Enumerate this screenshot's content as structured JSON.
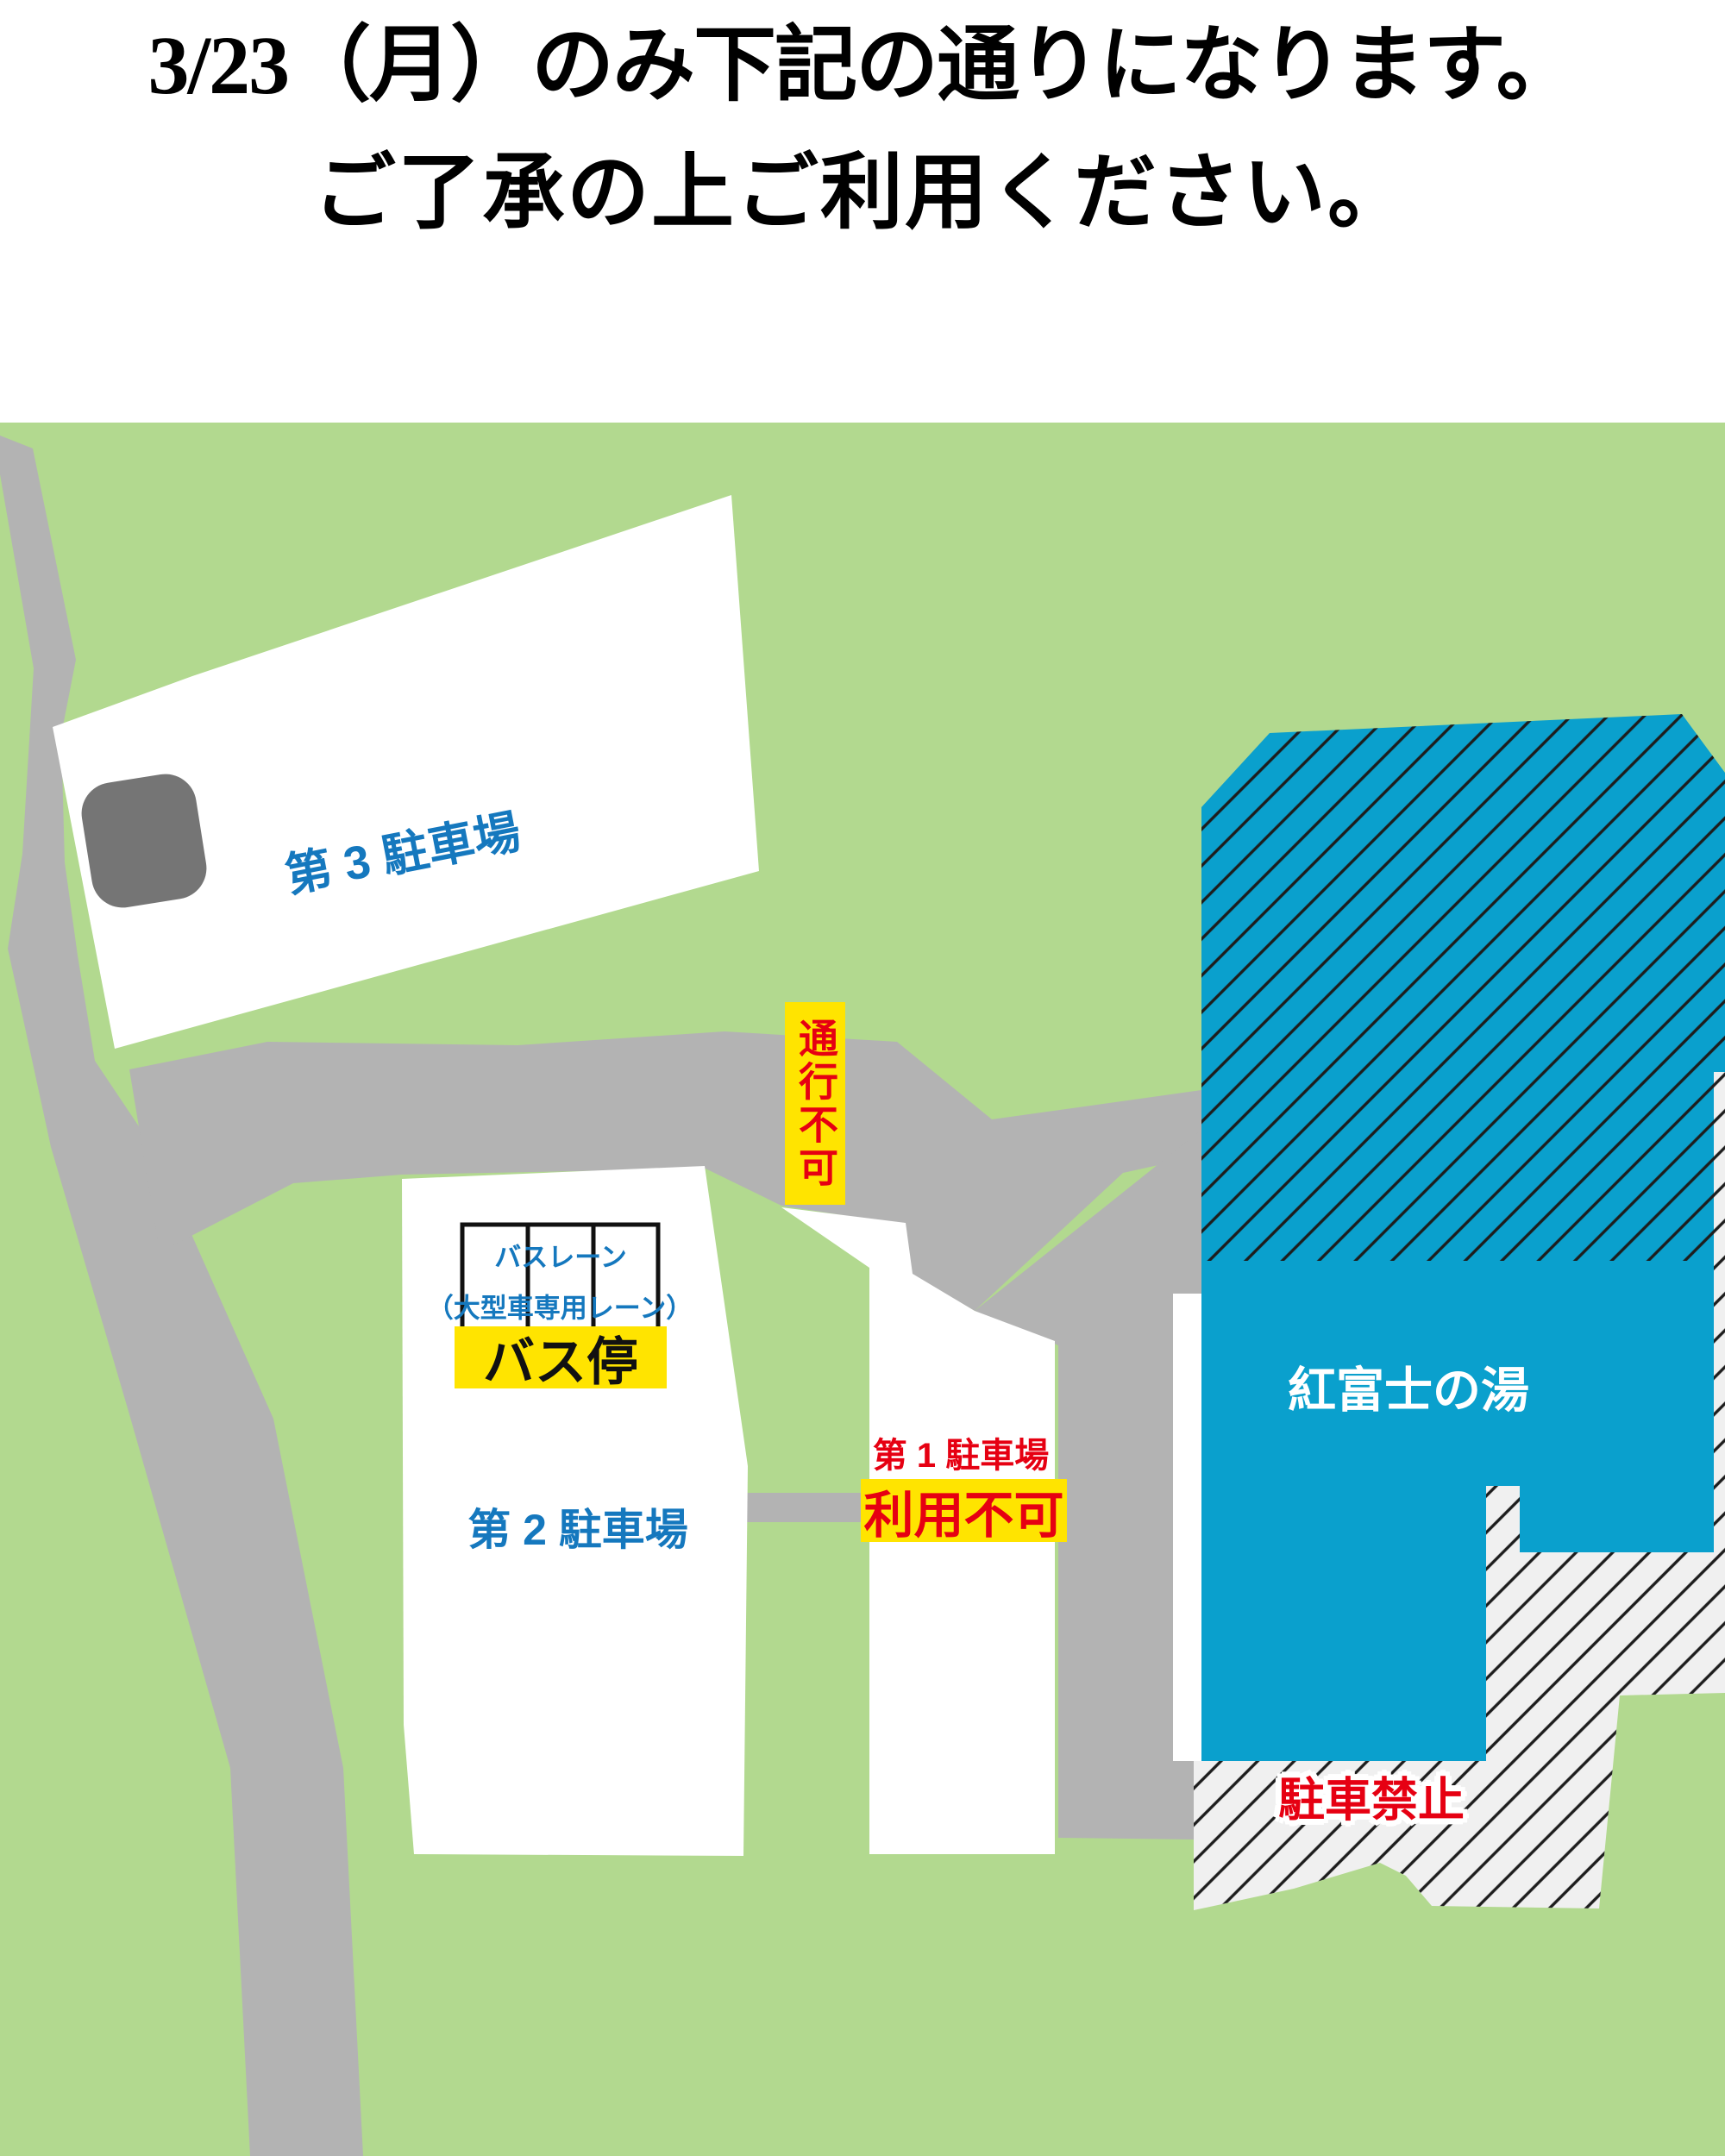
{
  "title": {
    "line1": "3/23（月）のみ下記の通りになります。",
    "line2": "ご了承の上ご利用ください。"
  },
  "map": {
    "lot3": {
      "label": "第 3 駐車場"
    },
    "lot2": {
      "label": "第 2 駐車場"
    },
    "lot1": {
      "label": "第 1 駐車場",
      "status": "利用不可"
    },
    "bus_lane": {
      "label": "バスレーン",
      "sub": "（大型車専用レーン）"
    },
    "bus_stop": {
      "label": "バス停"
    },
    "road_closed": {
      "label": "通行不可"
    },
    "building": {
      "label": "紅富士の湯"
    },
    "no_parking": {
      "label": "駐車禁止"
    }
  },
  "palette": {
    "grass_green": "#b2d98f",
    "road_gray": "#b3b3b3",
    "structure_gray": "#757575",
    "lot_white": "#ffffff",
    "building_blue": "#0aa0cd",
    "hatch_line": "#1d1d1d",
    "hatch_white": "#f0f0f0",
    "sign_yellow": "#ffe400",
    "alert_red": "#e60012",
    "label_blue": "#1578be",
    "title_black": "#000000"
  }
}
